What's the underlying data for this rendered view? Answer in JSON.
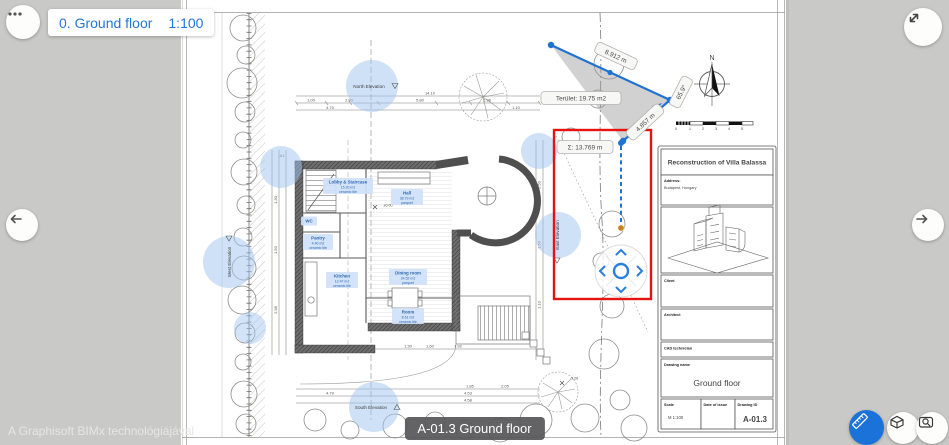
{
  "viewer": {
    "floor_label": "0. Ground floor",
    "floor_scale": "1:100",
    "watermark": "A Graphisoft BIMx technológiájával",
    "badge": "A-01.3 Ground floor",
    "accent_blue": "#2277d8",
    "selection_red": "#e51410"
  },
  "measure": {
    "dist1": "8.912 m",
    "dist2": "4.857 m",
    "angle": "65.9°",
    "area": "Terület: 19.75 m2",
    "total": "Σ: 13.769 m"
  },
  "plan": {
    "rooms": [
      {
        "name": "Lobby & Staircase",
        "area": "15.20 m2",
        "finish": "ceramic tile"
      },
      {
        "name": "Hall",
        "area": "38.79 m2",
        "finish": "parquet"
      },
      {
        "name": "WC",
        "area": "",
        "finish": ""
      },
      {
        "name": "Pantry",
        "area": "4.40 m2",
        "finish": "ceramic tile"
      },
      {
        "name": "Kitchen",
        "area": "12.47 m2",
        "finish": "ceramic tile"
      },
      {
        "name": "Dining room",
        "area": "24.52 m2",
        "finish": "parquet"
      },
      {
        "name": "Room",
        "area": "8.61 m2",
        "finish": "ceramic tile"
      }
    ],
    "elevations": {
      "north": "North Elevation",
      "south": "South Elevation",
      "west": "West Elevation",
      "east": "East Elevation"
    },
    "compass_n": "N",
    "section_mark": "A1",
    "dims_top": [
      "14.10",
      "1.00",
      "2.80",
      "5.80",
      "4.70",
      "2.98",
      "1.10"
    ],
    "dims_bottom": [
      "2.16",
      "1.30",
      "1.60",
      "1.92",
      "1.85",
      "2.05",
      "4.53",
      "4.58",
      "4.79"
    ],
    "dims_left": [
      "1.30",
      "1.50",
      "2.98"
    ],
    "dims_right": [
      "2.50",
      "1.50",
      "1.10"
    ],
    "level_marks": [
      "±0.00",
      "-3.26"
    ],
    "scale_numbers": [
      "0",
      "1",
      "2",
      "3",
      "4",
      "5"
    ]
  },
  "titleblock": {
    "title": "Reconstruction of Villa Balassa",
    "address_label": "Address:",
    "address": "Budapest, Hungary",
    "client_label": "Client",
    "architect_label": "Architect",
    "cad_label": "CAD technician",
    "drawing_name_label": "Drawing name",
    "drawing_name": "Ground floor",
    "scale_label": "Scale",
    "scale_value": "M 1:100",
    "date_label": "Date of issue",
    "id_label": "Drawing ID",
    "id_value": "A-01.3"
  }
}
